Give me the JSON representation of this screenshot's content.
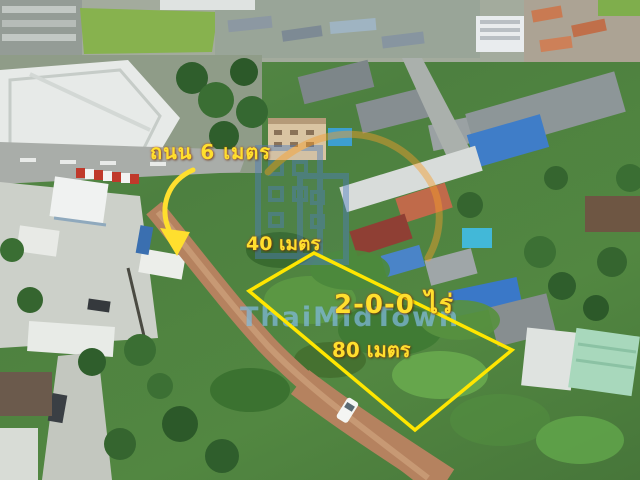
{
  "annotations": {
    "road": "ถนน 6 เมตร",
    "frontage": "40 เมตร",
    "area": "2-0-0 ไร่",
    "depth": "80 เมตร"
  },
  "watermark": {
    "text": "ThaiMidTown"
  },
  "colors": {
    "annotation_yellow": "#FFDF2E",
    "plot_outline_yellow": "#FFE600",
    "watermark_blue": "#8FCBE8",
    "logo_blue": "#4D7EC0",
    "logo_orange": "#F59E2B",
    "dirt_road_tan": "#B5825F",
    "vegetation_green": "#4D8040"
  }
}
